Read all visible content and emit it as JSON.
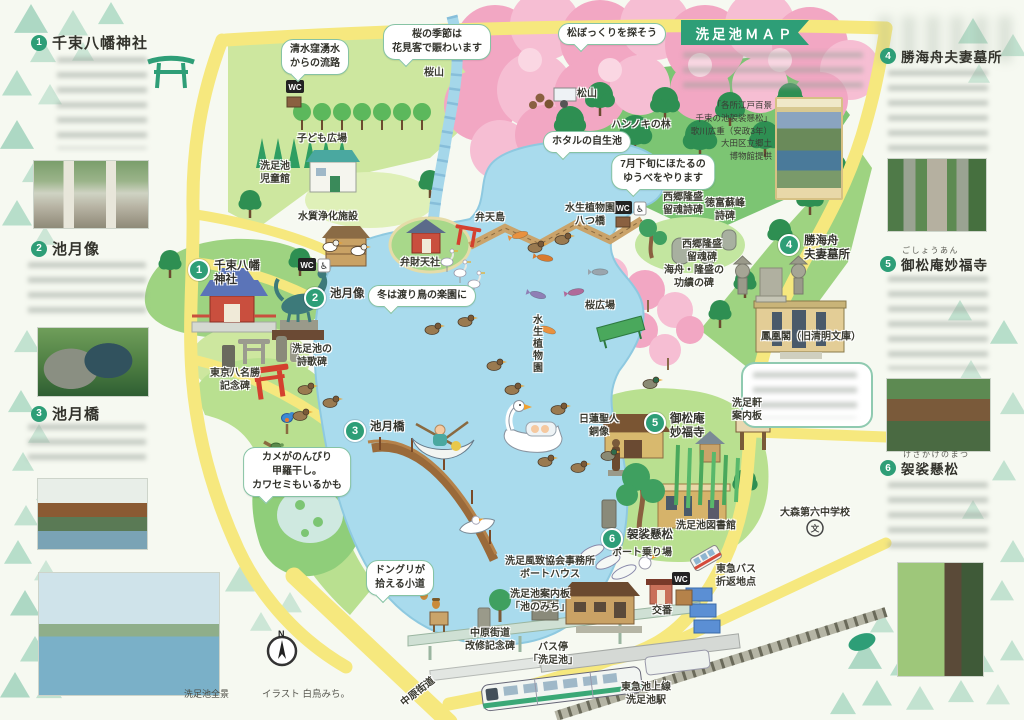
{
  "banner": {
    "title": "洗足池ＭＡＰ"
  },
  "sidebar_left": {
    "sections": [
      {
        "num": "1",
        "title": "千束八幡神社"
      },
      {
        "num": "2",
        "title": "池月像"
      },
      {
        "num": "3",
        "title": "池月橋"
      }
    ],
    "pond_photo_caption": "洗足池全景"
  },
  "sidebar_right": {
    "sections": [
      {
        "num": "4",
        "title": "勝海舟夫妻墓所",
        "furigana": ""
      },
      {
        "num": "5",
        "title": "御松庵妙福寺",
        "furigana": "ごしょうあん"
      },
      {
        "num": "6",
        "title": "袈裟懸松",
        "furigana": "けさか­けのまつ"
      }
    ]
  },
  "intro": {
    "ukiyoe_caption": "「各所江戸百景\n千束の池袈裟懸松」\n歌川広重（安政3年）\n大田区立郷土\n博物館提供"
  },
  "footer": {
    "credit": "イラスト 白鳥みち。",
    "compass_n": "N"
  },
  "map": {
    "wc_label": "WC",
    "school_mark": "文",
    "accessible_icon": "♿",
    "bubbles": [
      {
        "text": "清水窪湧水\nからの流路",
        "x": 315,
        "y": 57
      },
      {
        "text": "桜の季節は\n花見客で賑わいます",
        "x": 437,
        "y": 42
      },
      {
        "text": "松ぼっくりを探そう",
        "x": 612,
        "y": 34
      },
      {
        "text": "ホタルの自生池",
        "x": 587,
        "y": 142
      },
      {
        "text": "7月下旬にほたるの\nゆうべをやります",
        "x": 663,
        "y": 172
      },
      {
        "text": "冬は渡り鳥の楽園に",
        "x": 422,
        "y": 296
      },
      {
        "text": "カメがのんびり\n甲羅干し。\nカワセミもいるかも",
        "x": 297,
        "y": 472
      },
      {
        "text": "ドングリが\n拾える小道",
        "x": 400,
        "y": 578
      }
    ],
    "markers": [
      {
        "num": "1",
        "label": "千束八幡\n神社",
        "x": 197,
        "y": 268
      },
      {
        "num": "2",
        "label": "池月像",
        "x": 313,
        "y": 296
      },
      {
        "num": "3",
        "label": "池月橋",
        "x": 353,
        "y": 429
      },
      {
        "num": "4",
        "label": "勝海舟\n夫妻墓所",
        "x": 787,
        "y": 243
      },
      {
        "num": "5",
        "label": "御松庵\n妙福寺",
        "x": 653,
        "y": 421
      },
      {
        "num": "6",
        "label": "袈裟懸松",
        "x": 610,
        "y": 537
      }
    ],
    "labels": [
      {
        "text": "桜山",
        "x": 434,
        "y": 73
      },
      {
        "text": "子ども広場",
        "x": 322,
        "y": 139
      },
      {
        "text": "洗足池\n児童館",
        "x": 275,
        "y": 173
      },
      {
        "text": "水質浄化施設",
        "x": 328,
        "y": 217
      },
      {
        "text": "松山",
        "x": 587,
        "y": 94
      },
      {
        "text": "ハンノキの林",
        "x": 641,
        "y": 125
      },
      {
        "text": "弁天島",
        "x": 490,
        "y": 218
      },
      {
        "text": "弁財天社",
        "x": 420,
        "y": 263
      },
      {
        "text": "水生植物園\n八つ橋",
        "x": 590,
        "y": 215
      },
      {
        "text": "西郷隆盛\n留魂詩碑",
        "x": 683,
        "y": 204
      },
      {
        "text": "徳富蘇峰\n詩碑",
        "x": 725,
        "y": 210
      },
      {
        "text": "西郷隆盛\n留魂碑",
        "x": 702,
        "y": 251
      },
      {
        "text": "海舟・隆盛の\n功績の碑",
        "x": 694,
        "y": 277
      },
      {
        "text": "鳳凰閣（旧清明文庫）",
        "x": 811,
        "y": 337
      },
      {
        "text": "桜広場",
        "x": 600,
        "y": 306
      },
      {
        "text": "水生植物園",
        "x": 536,
        "y": 344,
        "vert": 1
      },
      {
        "text": "東京八名勝\n記念碑",
        "x": 235,
        "y": 380
      },
      {
        "text": "洗足池の\n詩歌碑",
        "x": 312,
        "y": 356
      },
      {
        "text": "日蓮聖人\n銅像",
        "x": 599,
        "y": 426
      },
      {
        "text": "洗足軒\n案内板",
        "x": 747,
        "y": 410
      },
      {
        "text": "洗足池図書館",
        "x": 706,
        "y": 526
      },
      {
        "text": "大森第六中学校",
        "x": 815,
        "y": 513
      },
      {
        "text": "東急バス\n折返地点",
        "x": 736,
        "y": 576
      },
      {
        "text": "ボート乗り場",
        "x": 642,
        "y": 553
      },
      {
        "text": "洗足風致協会事務所\nボートハウス",
        "x": 550,
        "y": 568
      },
      {
        "text": "洗足池案内板\n「池のみち」",
        "x": 540,
        "y": 601
      },
      {
        "text": "交番",
        "x": 662,
        "y": 611
      },
      {
        "text": "中原街道\n改修記念碑",
        "x": 490,
        "y": 640
      },
      {
        "text": "バス停\n「洗足池」",
        "x": 553,
        "y": 654
      },
      {
        "text": "東急池上線\n洗足池駅",
        "x": 646,
        "y": 694
      },
      {
        "text": "中原街道",
        "x": 418,
        "y": 692,
        "rot": -38
      }
    ]
  }
}
